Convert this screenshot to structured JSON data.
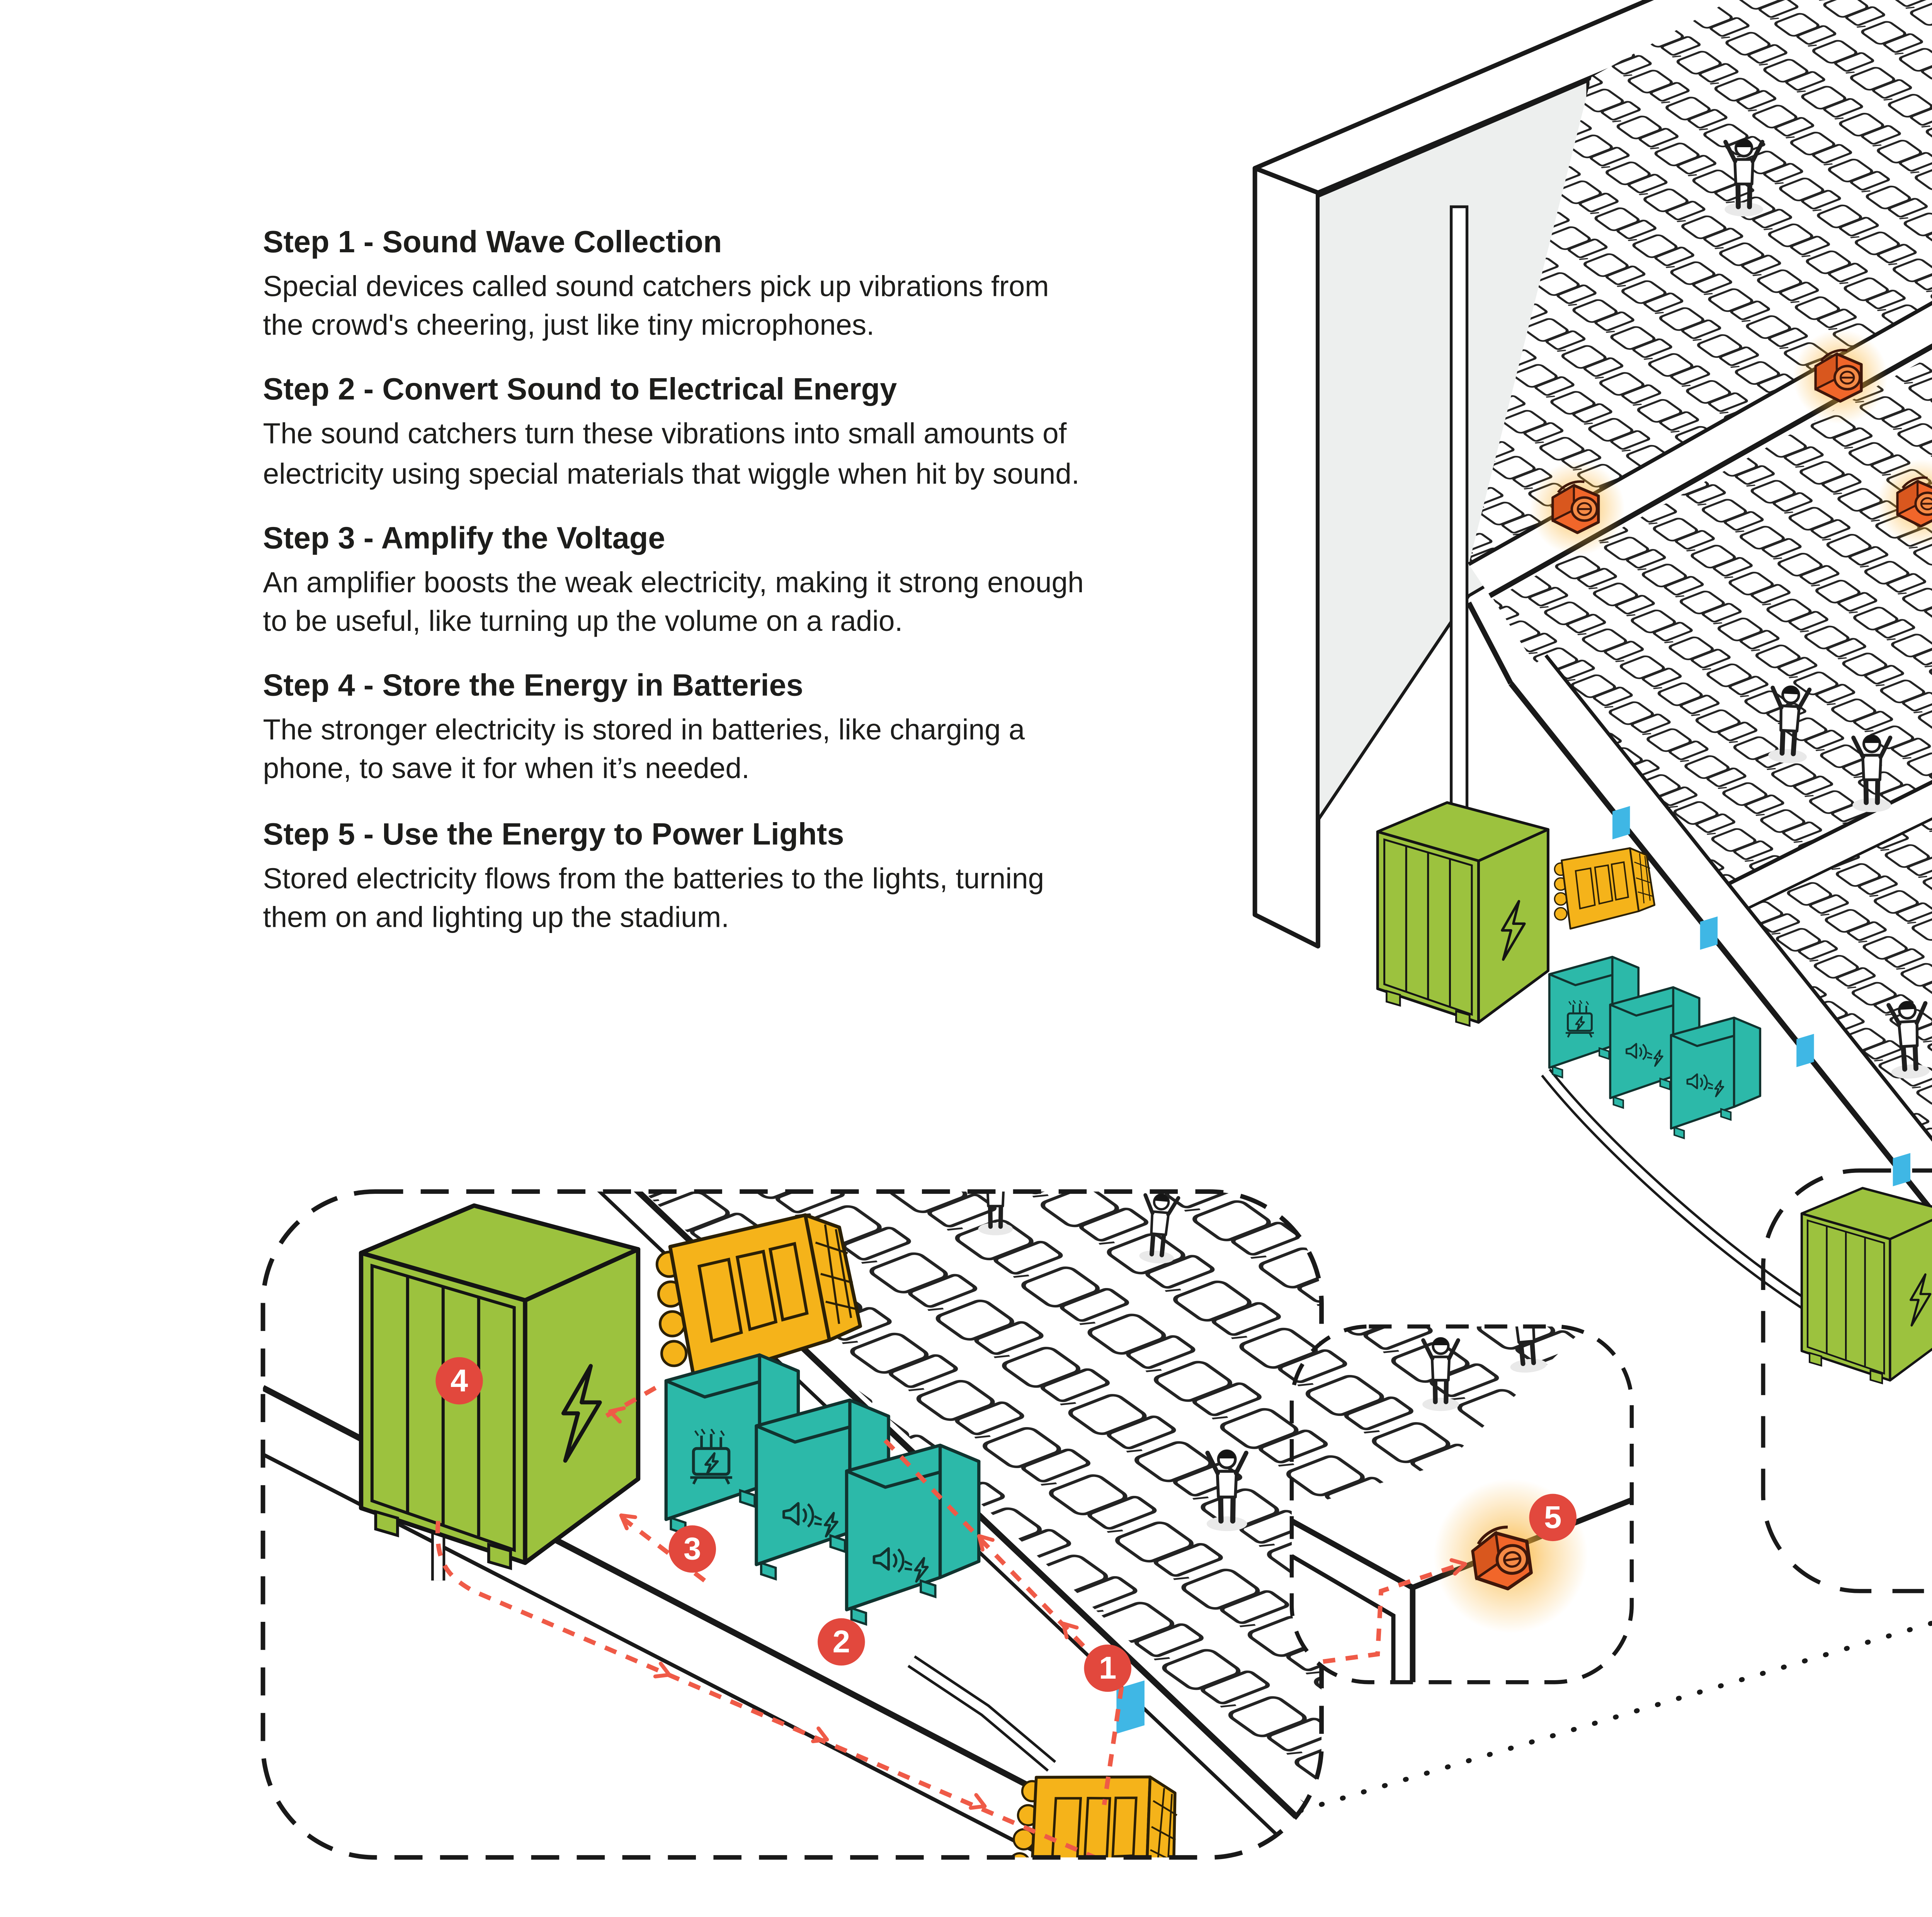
{
  "steps": [
    {
      "title": "Step 1 - Sound Wave Collection",
      "description": "Special devices called sound catchers pick up vibrations from the crowd's cheering, just like tiny microphones."
    },
    {
      "title": "Step 2 - Convert Sound to Electrical Energy",
      "description": "The sound catchers turn these vibrations into small amounts of electricity using special materials that wiggle when hit by sound."
    },
    {
      "title": "Step 3 - Amplify the Voltage",
      "description": "An amplifier boosts the weak electricity, making it strong enough to be useful, like turning up the volume on a radio."
    },
    {
      "title": "Step 4 - Store the Energy in Batteries",
      "description": "The stronger electricity is stored in batteries, like charging a phone, to save it for when it’s needed."
    },
    {
      "title": "Step 5 - Use the Energy to Power Lights",
      "description": "Stored electricity flows from the batteries to the lights, turning them on and lighting up the stadium."
    }
  ],
  "markers": [
    {
      "number": "1"
    },
    {
      "number": "2"
    },
    {
      "number": "3"
    },
    {
      "number": "4"
    },
    {
      "number": "5"
    }
  ],
  "colors": {
    "battery_green": "#9CC23E",
    "converter_teal": "#2CB9A9",
    "amplifier_yellow": "#F5B31A",
    "light_orange": "#F1662A",
    "glow_yellow": "#F9B233",
    "marker_red": "#E2483D",
    "wire_red": "#EF5A47",
    "catcher_blue": "#3FB7E5",
    "ink": "#191919"
  }
}
